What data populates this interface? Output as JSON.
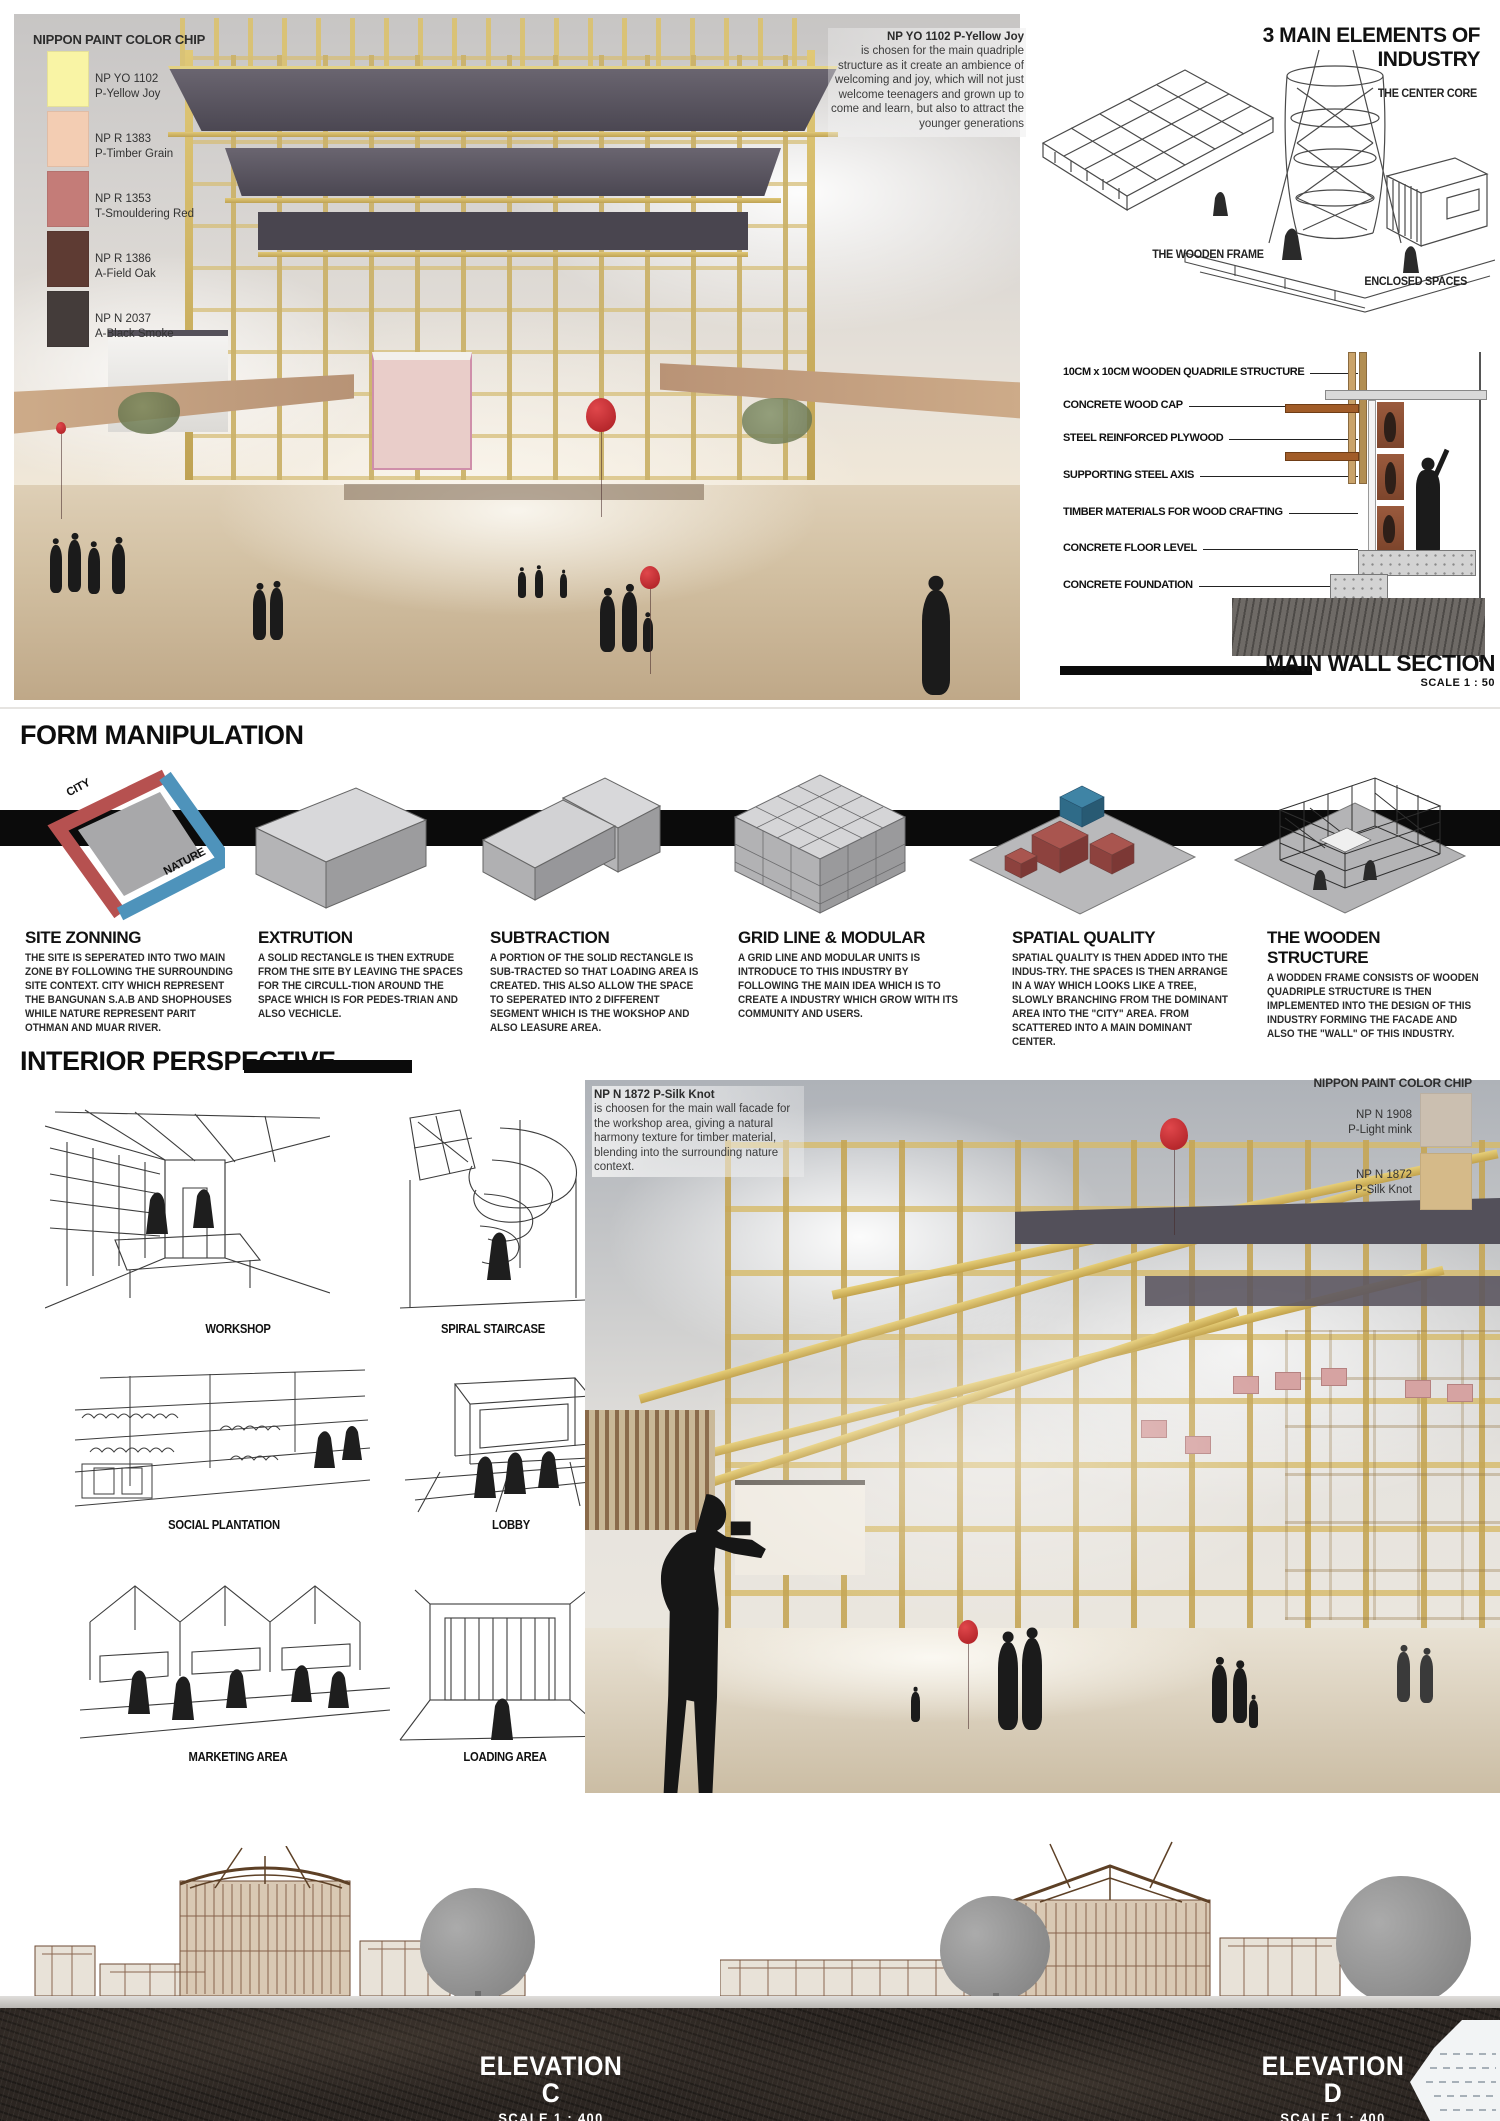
{
  "hero": {
    "chip_panel": {
      "title": "NIPPON PAINT COLOR CHIP",
      "chips": [
        {
          "code": "NP YO 1102",
          "name": "P-Yellow Joy",
          "color": "#f9f4a5"
        },
        {
          "code": "NP R 1383",
          "name": "P-Timber Grain",
          "color": "#f3cdb3"
        },
        {
          "code": "NP R 1353",
          "name": "T-Smouldering Red",
          "color": "#c47c78"
        },
        {
          "code": "NP R 1386",
          "name": "A-Field Oak",
          "color": "#5e3b33"
        },
        {
          "code": "NP N 2037",
          "name": "A-Black Smoke",
          "color": "#443c3a"
        }
      ]
    },
    "note_title": "NP YO 1102 P-Yellow Joy",
    "note_body": "is chosen for the main quadriple structure as it create an ambience of welcoming and joy, which will not just welcome teenagers and grown up to come and learn, but also to attract the younger generations"
  },
  "elements": {
    "title": "3 MAIN ELEMENTS OF INDUSTRY",
    "wooden_frame": "THE WOODEN FRAME",
    "center_core": "THE CENTER CORE",
    "enclosed_spaces": "ENCLOSED SPACES"
  },
  "wall_section": {
    "labels": [
      "10CM x 10CM WOODEN QUADRILE STRUCTURE",
      "CONCRETE WOOD CAP",
      "STEEL REINFORCED PLYWOOD",
      "SUPPORTING STEEL AXIS",
      "TIMBER MATERIALS FOR WOOD CRAFTING",
      "CONCRETE FLOOR LEVEL",
      "CONCRETE FOUNDATION"
    ],
    "title": "MAIN WALL SECTION",
    "scale": "SCALE 1 : 50"
  },
  "form_manipulation": {
    "title": "FORM MANIPULATION",
    "zone_labels": {
      "city": "CITY",
      "nature": "NATURE"
    },
    "steps": [
      {
        "title": "SITE ZONNING",
        "body": "THE SITE IS SEPERATED INTO TWO MAIN ZONE BY FOLLOWING THE SURROUNDING SITE CONTEXT. CITY WHICH REPRESENT THE BANGUNAN S.A.B AND SHOPHOUSES WHILE NATURE REPRESENT PARIT OTHMAN AND MUAR RIVER."
      },
      {
        "title": "EXTRUTION",
        "body": "A SOLID RECTANGLE IS THEN EXTRUDE FROM THE SITE BY LEAVING THE SPACES FOR THE CIRCULL-TION AROUND THE SPACE WHICH IS FOR PEDES-TRIAN AND ALSO VECHICLE."
      },
      {
        "title": "SUBTRACTION",
        "body": "A PORTION OF THE SOLID RECTANGLE IS SUB-TRACTED SO THAT LOADING AREA IS CREATED. THIS ALSO ALLOW THE SPACE TO SEPERATED INTO 2 DIFFERENT SEGMENT WHICH IS THE WOKSHOP AND ALSO LEASURE AREA."
      },
      {
        "title": "GRID LINE & MODULAR",
        "body": "A GRID LINE AND MODULAR UNITS IS INTRODUCE TO THIS INDUSTRY BY FOLLOWING THE MAIN IDEA WHICH IS TO CREATE A INDUSTRY WHICH GROW WITH ITS COMMUNITY AND USERS."
      },
      {
        "title": "SPATIAL QUALITY",
        "body": "SPATIAL QUALITY IS THEN ADDED INTO THE INDUS-TRY. THE SPACES IS THEN ARRANGE IN A WAY WHICH LOOKS LIKE A TREE, SLOWLY BRANCHING FROM THE DOMINANT AREA INTO THE \"CITY\" AREA. FROM SCATTERED INTO A MAIN DOMINANT CENTER."
      },
      {
        "title": "THE WOODEN STRUCTURE",
        "body": "A WODDEN FRAME CONSISTS OF WOODEN QUADRIPLE STRUCTURE IS THEN IMPLEMENTED INTO THE DESIGN OF THIS INDUSTRY FORMING THE FACADE AND ALSO THE \"WALL\" OF THIS INDUSTRY."
      }
    ]
  },
  "interior": {
    "title": "INTERIOR PERSPECTIVE",
    "sketch_labels": [
      "WORKSHOP",
      "SPIRAL STAIRCASE",
      "SOCIAL PLANTATION",
      "LOBBY",
      "MARKETING AREA",
      "LOADING AREA"
    ],
    "note_title": "NP N 1872 P-Silk Knot",
    "note_body": "is choosen for the main wall facade for the workshop area, giving a natural harmony texture for timber material, blending into the surrounding nature context.",
    "chip_panel": {
      "title": "NIPPON PAINT COLOR CHIP",
      "chips": [
        {
          "code": "NP N 1908",
          "name": "P-Light mink",
          "color": "#cbbfb0"
        },
        {
          "code": "NP N 1872",
          "name": "P-Silk Knot",
          "color": "#d5ba89"
        }
      ]
    }
  },
  "elevations": [
    {
      "title": "ELEVATION C",
      "scale": "SCALE 1 : 400"
    },
    {
      "title": "ELEVATION D",
      "scale": "SCALE 1 : 400"
    }
  ]
}
